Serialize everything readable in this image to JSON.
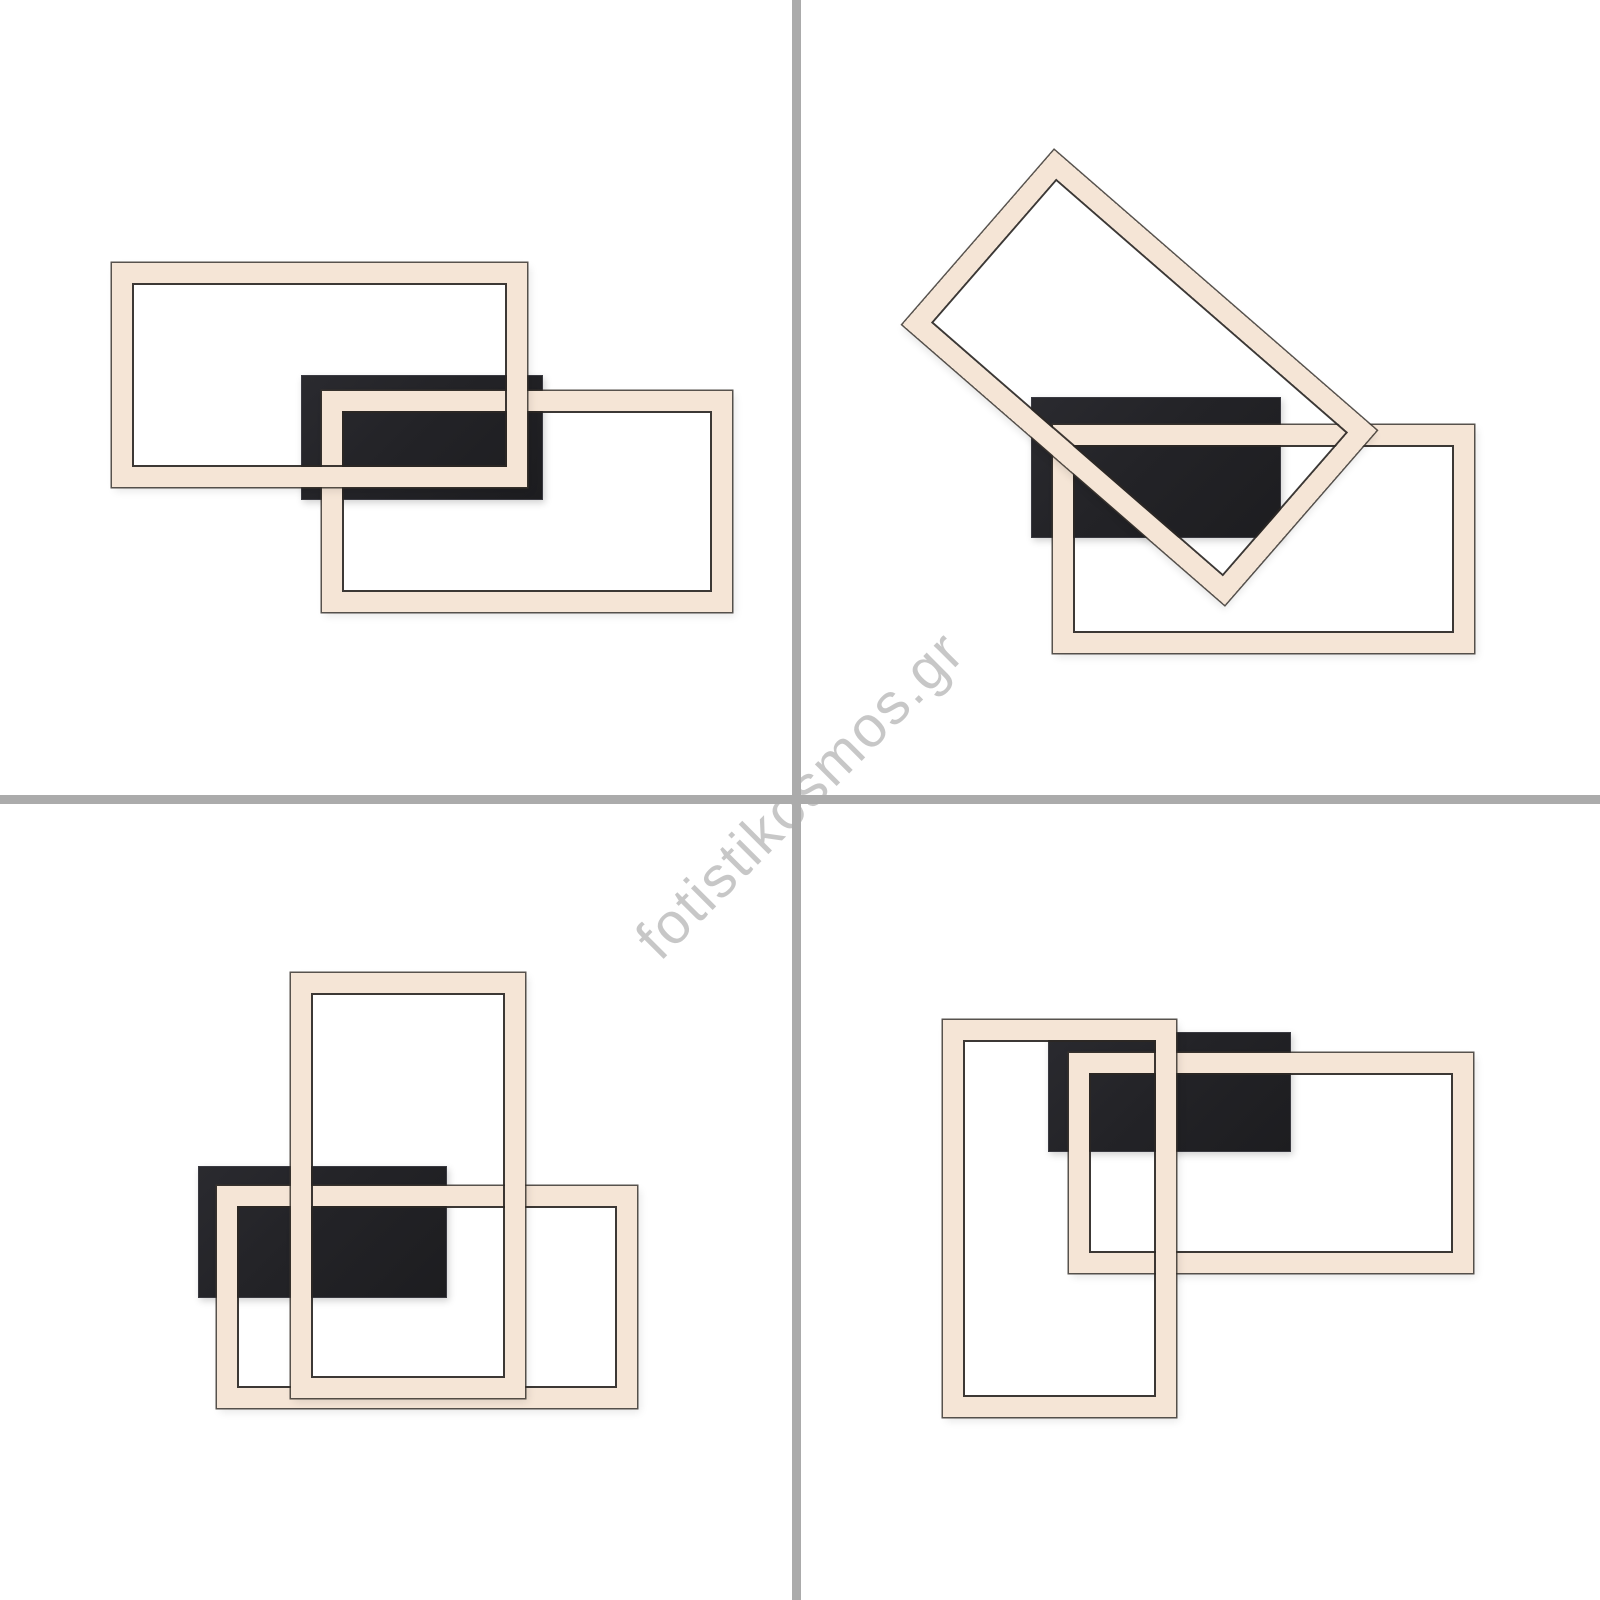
{
  "page": {
    "background": "#ffffff",
    "width": 1600,
    "height": 1600,
    "description": "2x2 product photo collage of a modern LED ceiling light with interlocking rectangular light frames and a black mounting plate, shown in four arrangements"
  },
  "watermark": {
    "text": "fotistikosmos.gr",
    "color": "rgba(0,0,0,0.22)",
    "rotation_deg": -45
  },
  "grid": {
    "divider_color": "#ababab",
    "vertical_x": 792,
    "vertical_width": 9,
    "horizontal_y": 795,
    "horizontal_height": 9
  },
  "colors": {
    "band_fill": "#f5e5d6",
    "band_outline": "#352f2b",
    "plate_fill": "#232327"
  },
  "panels": [
    {
      "id": "top-left",
      "description": "Two interlocking landscape LED frames, black canopy behind the overlap",
      "shapes": [
        {
          "kind": "plate",
          "x": 301,
          "y": 375,
          "w": 242,
          "h": 125
        },
        {
          "kind": "frame",
          "x": 322,
          "y": 391,
          "w": 410,
          "h": 221
        },
        {
          "kind": "frame",
          "x": 112,
          "y": 263,
          "w": 415,
          "h": 224
        }
      ]
    },
    {
      "id": "top-right",
      "description": "One LED frame swivelled diagonally over a landscape LED frame, black canopy behind",
      "shapes": [
        {
          "kind": "plate",
          "x": 1031,
          "y": 397,
          "w": 250,
          "h": 141
        },
        {
          "kind": "frame",
          "x": 1053,
          "y": 425,
          "w": 421,
          "h": 228
        },
        {
          "kind": "frame",
          "x": 926,
          "y": 262,
          "w": 427,
          "h": 231,
          "rotate": 41
        }
      ]
    },
    {
      "id": "bottom-left",
      "description": "Portrait LED frame crossing a landscape LED frame, black canopy behind left side",
      "shapes": [
        {
          "kind": "plate",
          "x": 198,
          "y": 1166,
          "w": 249,
          "h": 132
        },
        {
          "kind": "frame",
          "x": 217,
          "y": 1186,
          "w": 420,
          "h": 222
        },
        {
          "kind": "frame",
          "x": 291,
          "y": 973,
          "w": 234,
          "h": 425
        }
      ]
    },
    {
      "id": "bottom-right",
      "description": "Portrait LED frame at left interlocked with landscape LED frame at right, black canopy behind top",
      "shapes": [
        {
          "kind": "plate",
          "x": 1048,
          "y": 1032,
          "w": 243,
          "h": 120
        },
        {
          "kind": "frame",
          "x": 1069,
          "y": 1053,
          "w": 404,
          "h": 220
        },
        {
          "kind": "frame",
          "x": 943,
          "y": 1020,
          "w": 233,
          "h": 397
        }
      ]
    }
  ]
}
